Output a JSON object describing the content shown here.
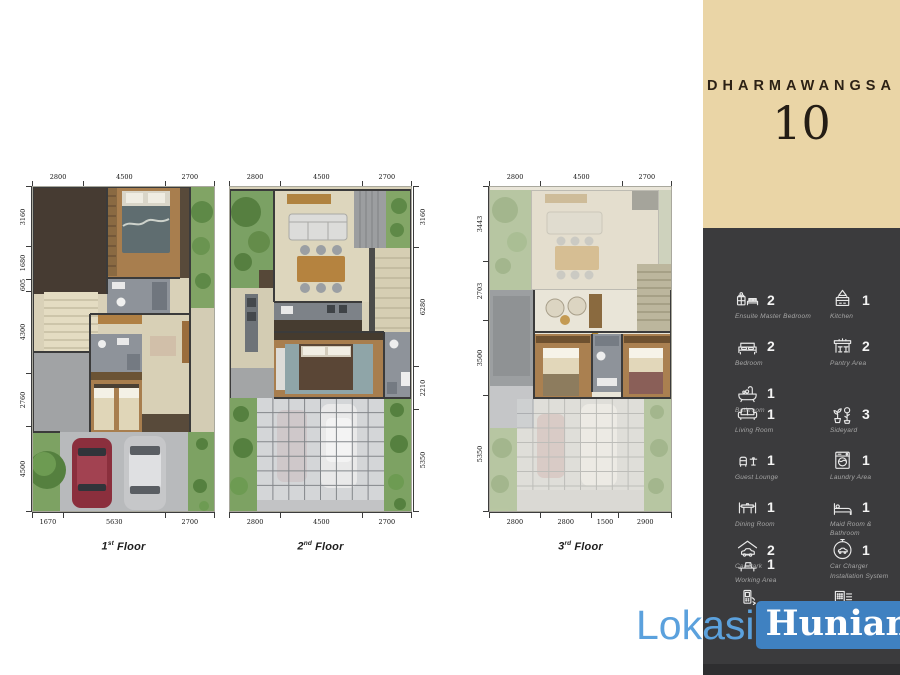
{
  "header": {
    "project": "DHARMAWANGSA",
    "number": "10"
  },
  "floors": [
    {
      "label": {
        "num": "1",
        "sup": "st",
        "word": "Floor"
      },
      "dims": {
        "top": [
          "2800",
          "4500",
          "2700"
        ],
        "left": [
          "3160",
          "1680",
          "605",
          "4300",
          "2760",
          "4500"
        ],
        "bottom": [
          "1670",
          "5630",
          "2700"
        ]
      }
    },
    {
      "label": {
        "num": "2",
        "sup": "nd",
        "word": "Floor"
      },
      "dims": {
        "top": [
          "2800",
          "4500",
          "2700"
        ],
        "right": [
          "3160",
          "6280",
          "2210",
          "5350"
        ],
        "bottom": [
          "2800",
          "4500",
          "2700"
        ]
      }
    },
    {
      "label": {
        "num": "3",
        "sup": "rd",
        "word": "Floor"
      },
      "dims": {
        "top": [
          "2800",
          "4500",
          "2700"
        ],
        "left": [
          "3443",
          "2703",
          "3500",
          "5350"
        ],
        "bottom": [
          "2800",
          "2800",
          "1500",
          "2900"
        ]
      }
    }
  ],
  "legend": {
    "sections": [
      {
        "items": [
          {
            "icon": "ensuite-master-bedroom",
            "label": "Ensuite Master Bedroom",
            "count": "2"
          },
          {
            "icon": "kitchen",
            "label": "Kitchen",
            "count": "1"
          },
          {
            "icon": "bedroom",
            "label": "Bedroom",
            "count": "2"
          },
          {
            "icon": "pantry-area",
            "label": "Pantry Area",
            "count": "2"
          },
          {
            "icon": "bathroom",
            "label": "Bathroom",
            "count": "1"
          }
        ]
      },
      {
        "items": [
          {
            "icon": "living-room",
            "label": "Living Room",
            "count": "1"
          },
          {
            "icon": "sideyard",
            "label": "Sideyard",
            "count": "3"
          },
          {
            "icon": "guest-lounge",
            "label": "Guest Lounge",
            "count": "1"
          },
          {
            "icon": "laundry-area",
            "label": "Laundry Area",
            "count": "1"
          },
          {
            "icon": "dining-room",
            "label": "Dining Room",
            "count": "1"
          },
          {
            "icon": "maid-room-bathroom",
            "label": "Maid Room & Bathroom",
            "count": "1"
          },
          {
            "icon": "working-area",
            "label": "Working Area",
            "count": "1"
          }
        ]
      },
      {
        "items": [
          {
            "icon": "car-park",
            "label": "Car Park",
            "count": "2"
          },
          {
            "icon": "car-charger",
            "label": "Car Charger Installation System",
            "count": "1"
          }
        ]
      },
      {
        "items": [
          {
            "icon": "video-intercom",
            "label": "",
            "count": ""
          },
          {
            "icon": "wireless-security",
            "label": "Wireless Security",
            "count": ""
          }
        ]
      }
    ]
  },
  "watermark": {
    "part1": "Lokasi",
    "part2": "Hunian"
  },
  "colors": {
    "accent_beige": "#ead5a6",
    "panel_dark": "#3b3b3d",
    "watermark_text_blue": "#5ba1dd",
    "watermark_box_blue": "#3f81c1"
  }
}
